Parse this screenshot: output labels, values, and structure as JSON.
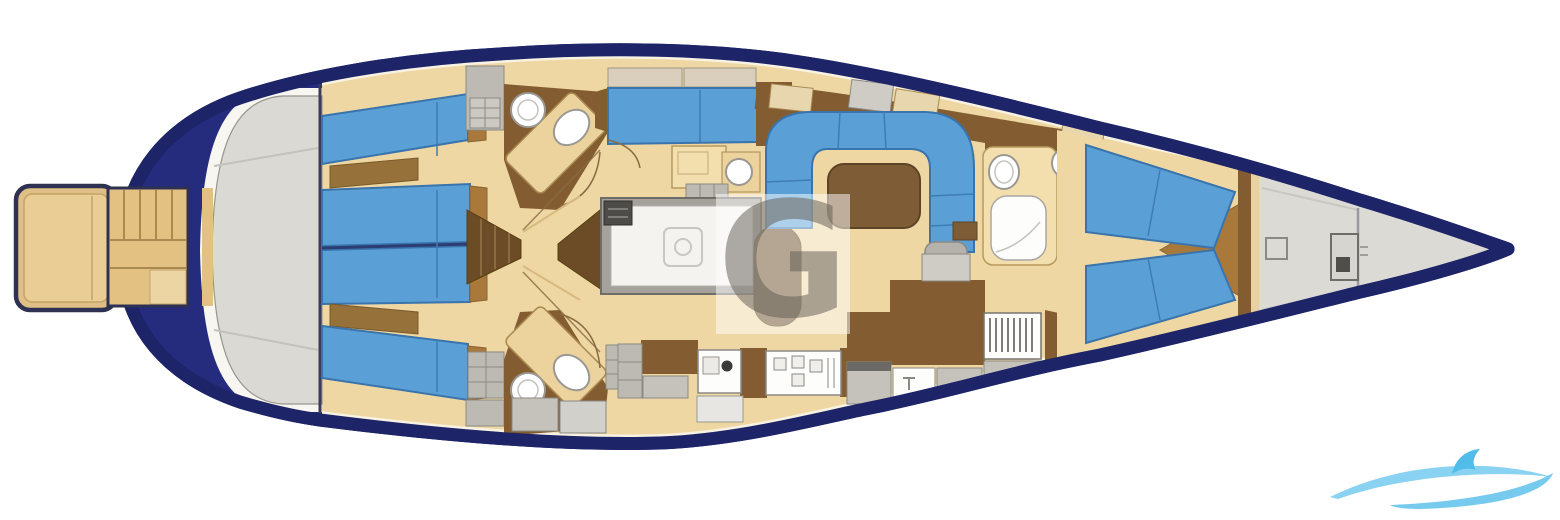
{
  "watermark": {
    "letter": "G"
  },
  "palette": {
    "hull_navy": "#1d2468",
    "stern_navy_fill": "#252c7e",
    "cushion_blue": "#5aa0d6",
    "cushion_seam": "#3e7cb4",
    "floor_tan": "#eed7a3",
    "cream_margin": "#f7f2e2",
    "wood_brown": "#835d31",
    "dark_wood": "#6b4c26",
    "cap_wood": "#a9793c",
    "vanity_tan": "#ecd29c",
    "deck_gray": "#dbd9d4",
    "locker_gray": "#bdbab4",
    "fixture_white": "#fdfdfc",
    "table_brown": "#7d5c36",
    "platform_tan": "#e2c183",
    "logo_blue": "#8ad2f2"
  },
  "features": [
    "swim-platform",
    "passerelle-steps",
    "transom-deck",
    "hull",
    "aft-berth-port-outer",
    "aft-berth-port-inner",
    "aft-berth-starboard-inner",
    "aft-berth-starboard-outer",
    "head-port",
    "head-starboard",
    "companionway-steps",
    "passage-floor",
    "midship-cabin-port",
    "engine-room",
    "nav-seat",
    "salon-settee",
    "salon-table",
    "galley-counter",
    "galley-sink",
    "galley-stove",
    "forward-head",
    "hanging-locker",
    "v-berth-port",
    "v-berth-starboard",
    "forepeak",
    "deck-hatch",
    "windlass",
    "center-watermark",
    "logo-swoosh"
  ]
}
